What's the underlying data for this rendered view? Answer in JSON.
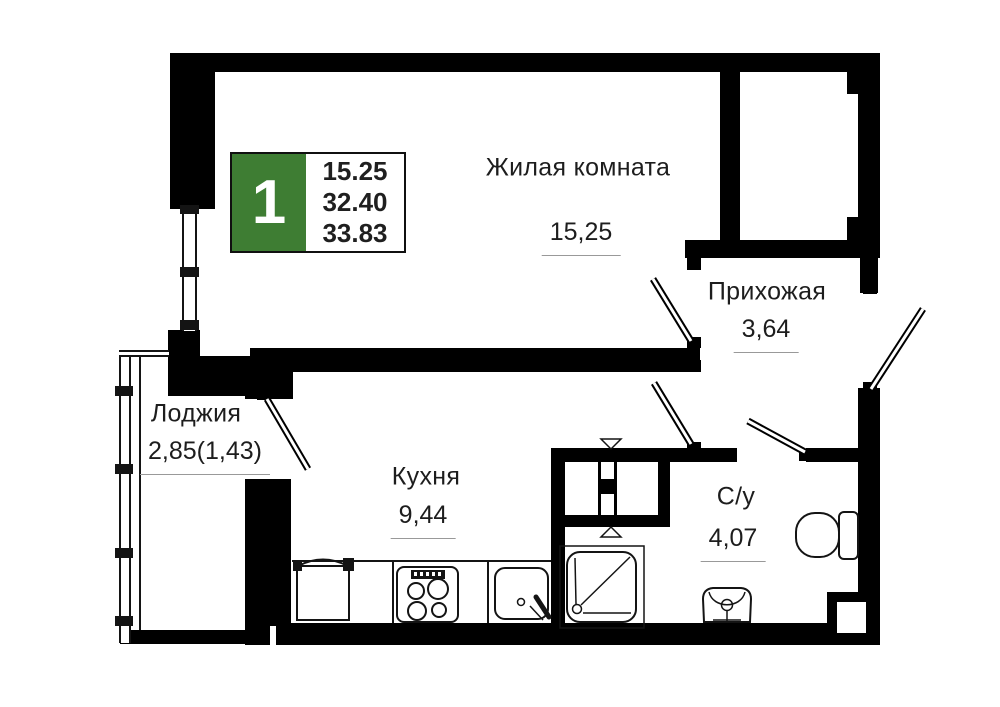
{
  "badge": {
    "rooms_count": "1",
    "values": [
      "15.25",
      "32.40",
      "33.83"
    ]
  },
  "rooms": [
    {
      "name": "Жилая комната",
      "area": "15,25"
    },
    {
      "name": "Прихожая",
      "area": "3,64"
    },
    {
      "name": "Лоджия",
      "area": "2,85(1,43)"
    },
    {
      "name": "Кухня",
      "area": "9,44"
    },
    {
      "name": "С/у",
      "area": "4,07"
    }
  ],
  "fixtures": [
    "fridge",
    "stove",
    "sink",
    "shower",
    "washbasin",
    "toilet",
    "vent-shaft"
  ],
  "colors": {
    "wall": "#000000",
    "background": "#ffffff",
    "badge_green": "#3e7d33",
    "text": "#1d1d1d",
    "area_underline": "#999999"
  }
}
